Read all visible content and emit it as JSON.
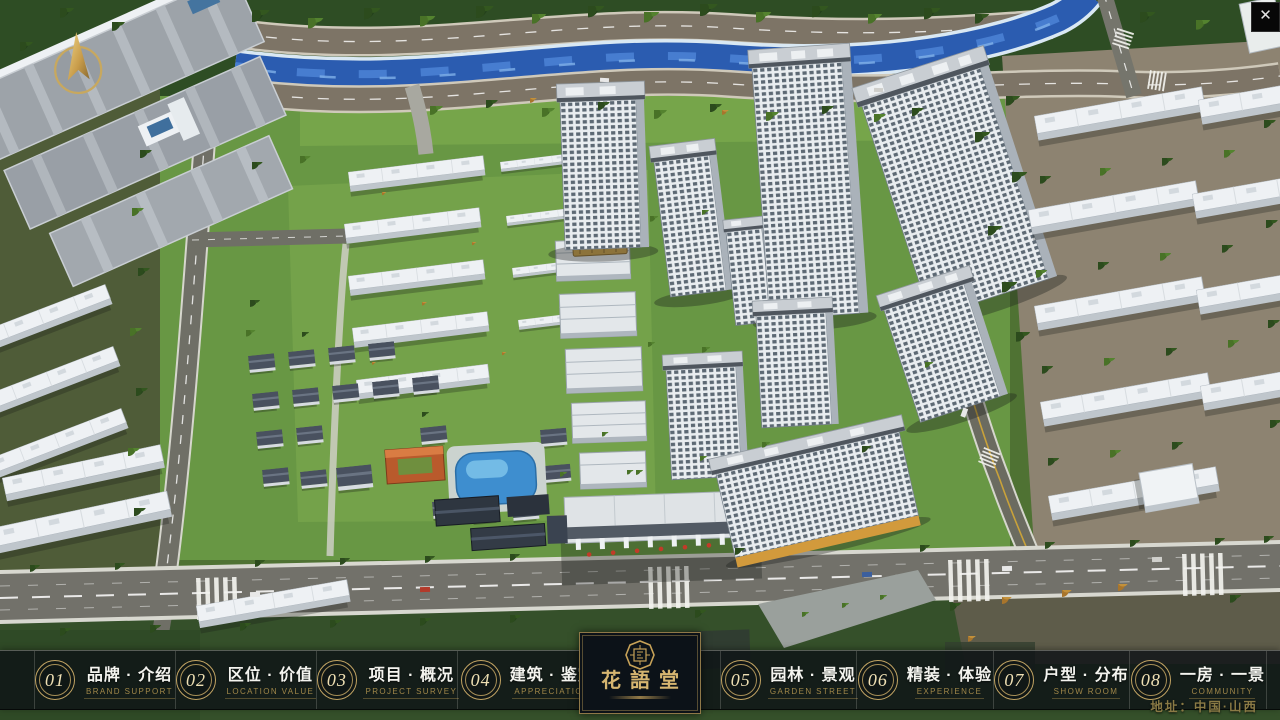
{
  "window": {
    "close": "✕"
  },
  "menu": {
    "items": [
      {
        "number": "01",
        "label": "品牌 · 介绍",
        "sublabel": "BRAND SUPPORT"
      },
      {
        "number": "02",
        "label": "区位 · 价值",
        "sublabel": "LOCATION VALUE"
      },
      {
        "number": "03",
        "label": "项目 · 概况",
        "sublabel": "PROJECT SURVEY"
      },
      {
        "number": "04",
        "label": "建筑 · 鉴赏",
        "sublabel": "APPRECIATION"
      },
      {
        "number": "05",
        "label": "园林 · 景观",
        "sublabel": "GARDEN STREET"
      },
      {
        "number": "06",
        "label": "精装 · 体验",
        "sublabel": "EXPERIENCE"
      },
      {
        "number": "07",
        "label": "户型 · 分布",
        "sublabel": "SHOW ROOM"
      },
      {
        "number": "08",
        "label": "一房 · 一景",
        "sublabel": "COMMUNITY"
      }
    ]
  },
  "logo": {
    "title": "花語堂"
  },
  "footer": {
    "address": "地址：中国·山西"
  }
}
